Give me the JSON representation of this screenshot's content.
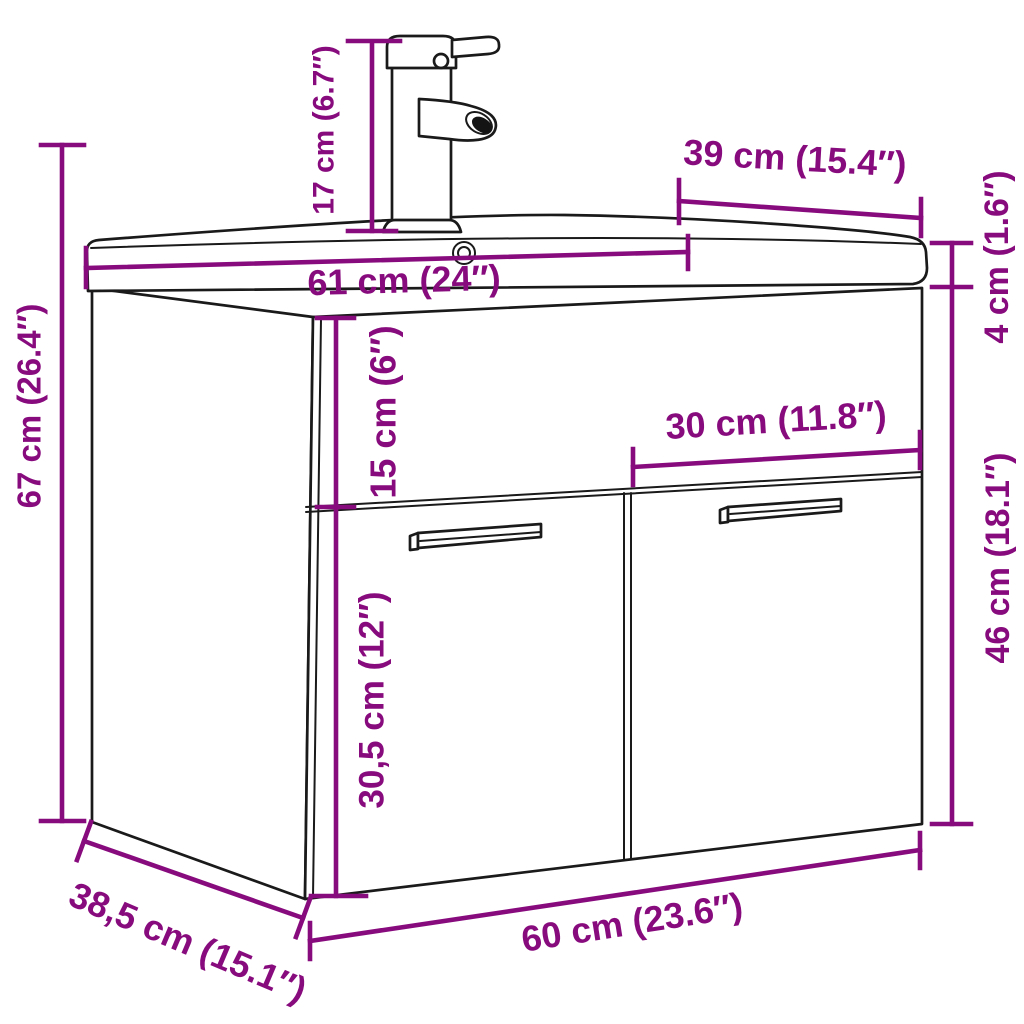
{
  "diagram": {
    "figure_type": "product dimension diagram",
    "subject": "bathroom vanity cabinet with washbasin and faucet",
    "accent_color": "#880b7e",
    "line_color": "#1a1a1a",
    "background_color": "#ffffff",
    "dimensions": {
      "faucet_height": "17 cm (6.7″)",
      "sink_depth": "39 cm (15.4″)",
      "sink_width": "61 cm (24″)",
      "basin_height": "4 cm (1.6″)",
      "total_height": "67 cm (26.4″)",
      "drawer_height": "15 cm (6″)",
      "door_width": "30 cm (11.8″)",
      "door_height": "46 cm (18.1″)",
      "handle_height": "30,5 cm (12″)",
      "cabinet_depth": "38,5 cm (15.1″)",
      "cabinet_width": "60 cm (23.6″)"
    }
  }
}
